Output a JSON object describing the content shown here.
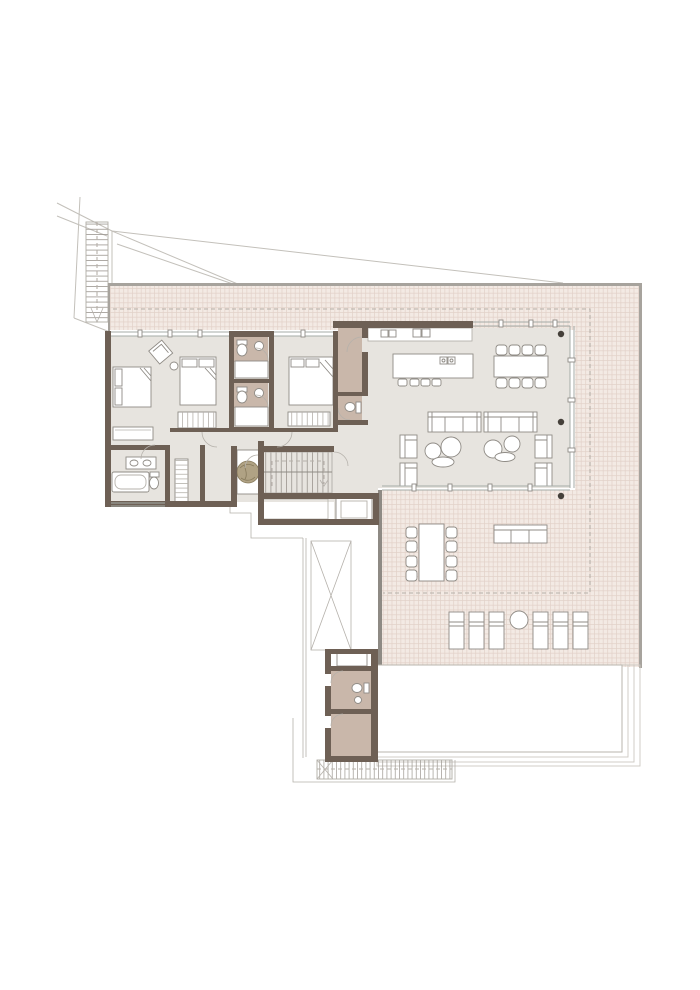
{
  "document": {
    "type": "architectural-floor-plan",
    "level": "upper-floor-villa-plan",
    "visible_text": []
  },
  "colors": {
    "bg": "#ffffff",
    "wall": "#6e6055",
    "floor": "#e7e4df",
    "taupe": "#c9b7aa",
    "terr-fill": "#f3eae4",
    "terr-line": "#e2d1c8",
    "terr-border": "#a7a39d",
    "terr-border-dark": "#8e8a84",
    "stroke": "#8f8b85",
    "stroke-light": "#b5b1ab",
    "glass": "#a4aba7",
    "dash": "#b6b0a9",
    "site": "#c3c0ba",
    "pool": "#b9b5ae",
    "pool-light": "#ccc8c1",
    "col": "#45403a",
    "plant": "#b0a284",
    "plant-dark": "#877a5c",
    "tread": "#9b968f"
  },
  "plan": {
    "rooms": [
      "bedroom-1",
      "bedroom-2",
      "bedroom-3",
      "bathroom-1",
      "bathroom-2",
      "master-bathroom",
      "dressing-room",
      "entry-hall",
      "staircase",
      "elevator",
      "pantry",
      "wc",
      "kitchen",
      "living-dining-room",
      "terrace",
      "pool",
      "pool-house",
      "lower-deck"
    ],
    "furniture": {
      "beds": 3,
      "indoor_dining_chairs": 8,
      "outdoor_dining_chairs": 8,
      "sofas_indoor": 2,
      "armchairs_indoor": 4,
      "outdoor_sofa": 1,
      "sun_loungers": 6,
      "kitchen_stools": 4,
      "toilets": 5,
      "planters": 1
    }
  }
}
